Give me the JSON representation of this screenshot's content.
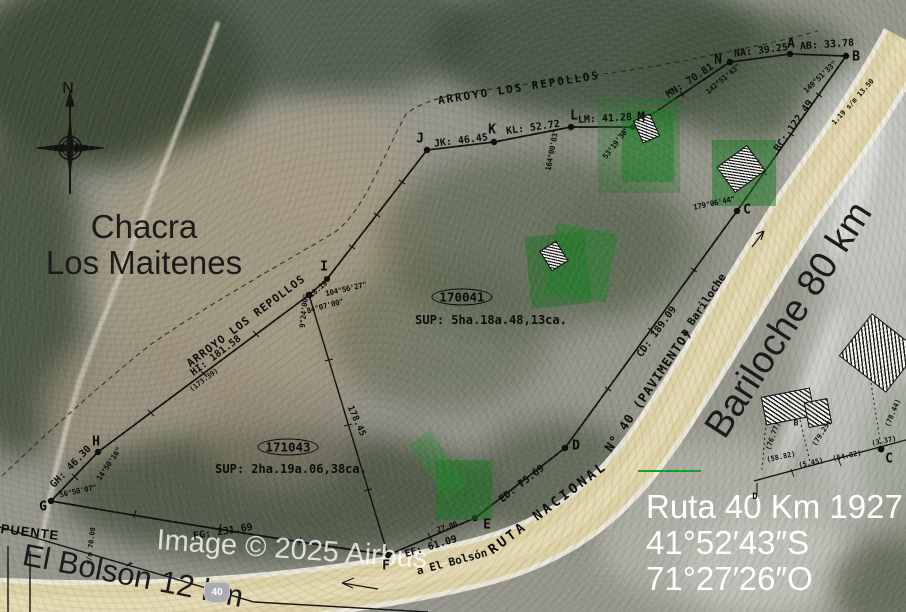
{
  "map": {
    "region_labels": {
      "chacra_1": "Chacra",
      "chacra_2": "Los Maitenes",
      "bariloche": "Bariloche 80 km",
      "el_bolson": "El Bolsón 12 km",
      "puente": "PUENTE",
      "arroyo_top": "ARROYO LOS REPOLLOS",
      "arroyo_left": "ARROYO LOS REPOLLOS"
    },
    "road": {
      "ruta_nacional": "RUTA NACIONAL",
      "pavimento": "N° 40 (PAVIMENTO)",
      "a_bariloche": "a Bariloche",
      "a_el_bolson": "a El Bolsón",
      "shield": "40"
    },
    "info_overlay": {
      "line1": "Ruta 40 Km 1927",
      "line2": "41°52′43″S",
      "line3": "71°27′26″O"
    },
    "watermark": "Image © 2025 Airbus",
    "compass": {
      "north": "N"
    },
    "parcels": {
      "p1": {
        "id": "170041",
        "sup": "SUP:  5ha.18a.48,13ca."
      },
      "p2": {
        "id": "171043",
        "sup": "SUP:  2ha.19a.06,38ca."
      }
    },
    "points": {
      "a": "A",
      "b": "B",
      "c": "C",
      "d": "D",
      "e": "E",
      "f": "F",
      "g": "G",
      "h": "H",
      "i": "I",
      "j": "J",
      "k": "K",
      "l": "L",
      "m": "M",
      "n": "N",
      "c2": "C",
      "d2": "D",
      "b2": "B"
    },
    "distances": {
      "ab": "AB:  33.78",
      "na": "NA:  39.25",
      "mn": "MN:  70.81",
      "lm": "LM:  41.28",
      "kl": "KL:  52.72",
      "jk": "JK:  46.45",
      "ij": "18.19",
      "hi": "HI:  181.58",
      "hi_alt": "(173.39)",
      "gh": "GH:  46.30",
      "fg": "FG:  231.69",
      "ef": "EF:  61.09",
      "ed": "ED:  75.69",
      "cd": "CD:  189.09",
      "bc": "BC:  122.49",
      "internal": "178.45",
      "e_offset": "27.00",
      "b_offset": "1.19 s/m 13.50",
      "g_offset": "s/m 70.08"
    },
    "bearings": {
      "near_n": "142°51'43\"",
      "near_ab": "149°51'33\"",
      "near_m": "53°19'30\"",
      "near_k": "164°00'03\"",
      "near_i1": "104°56'27\"",
      "near_i2": "9°24'00\"",
      "near_i3": "84°07'00\"",
      "near_h": "14°50'16\"",
      "near_g": "56°50'07\"",
      "near_c": "179°06'44\""
    },
    "ref_measures": {
      "m1": "(58.82)",
      "m2": "(5.45)",
      "m3": "(54.82)",
      "m4": "(3.37)",
      "w1": "(76.77)",
      "w2": "(79.25)",
      "w3": "(78.44)"
    },
    "colors": {
      "overlay_green": "#169023",
      "boundary": "#111111",
      "road_fill": "#ddd1a4",
      "highlight_green_line": "#14a11c"
    }
  }
}
